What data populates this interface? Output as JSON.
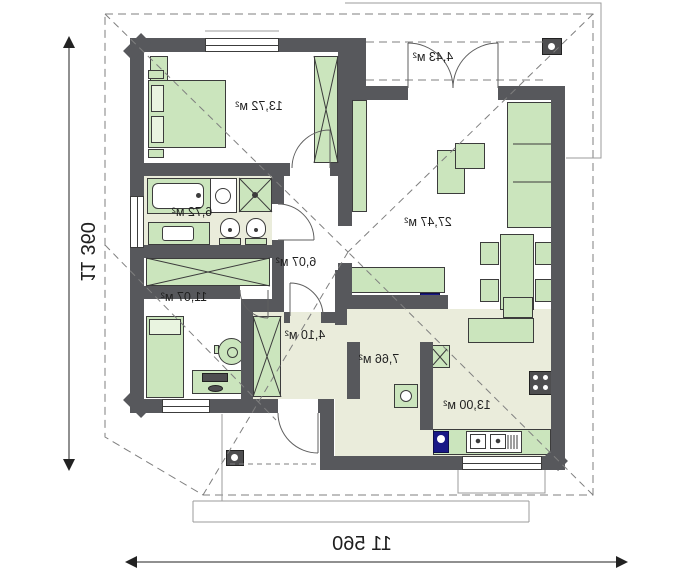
{
  "colors": {
    "wall": "#57585c",
    "furn": "#cbe5bd",
    "furn-light": "#e9f4e0",
    "floor": "#eaecdb",
    "navy": "#191986",
    "line": "#3c3c3c",
    "dash": "#7f7f7f",
    "thin": "#9b9b9b",
    "text": "#1f1f1f"
  },
  "plan": {
    "rooms": [
      {
        "id": "bedroom-main",
        "area": "13,72 м²"
      },
      {
        "id": "porch",
        "area": "4,43 м²"
      },
      {
        "id": "bathroom",
        "area": "6,72 м²"
      },
      {
        "id": "living-room",
        "area": "27,47 м²"
      },
      {
        "id": "corridor",
        "area": "6,07 м²"
      },
      {
        "id": "bedroom-second",
        "area": "11,07 м²"
      },
      {
        "id": "hall",
        "area": "4,10 м²"
      },
      {
        "id": "hallway",
        "area": "7,66 м²"
      },
      {
        "id": "kitchen",
        "area": "13,00 м²"
      }
    ],
    "dimensions": {
      "overall_width": "11 560",
      "overall_height": "11 360"
    }
  }
}
